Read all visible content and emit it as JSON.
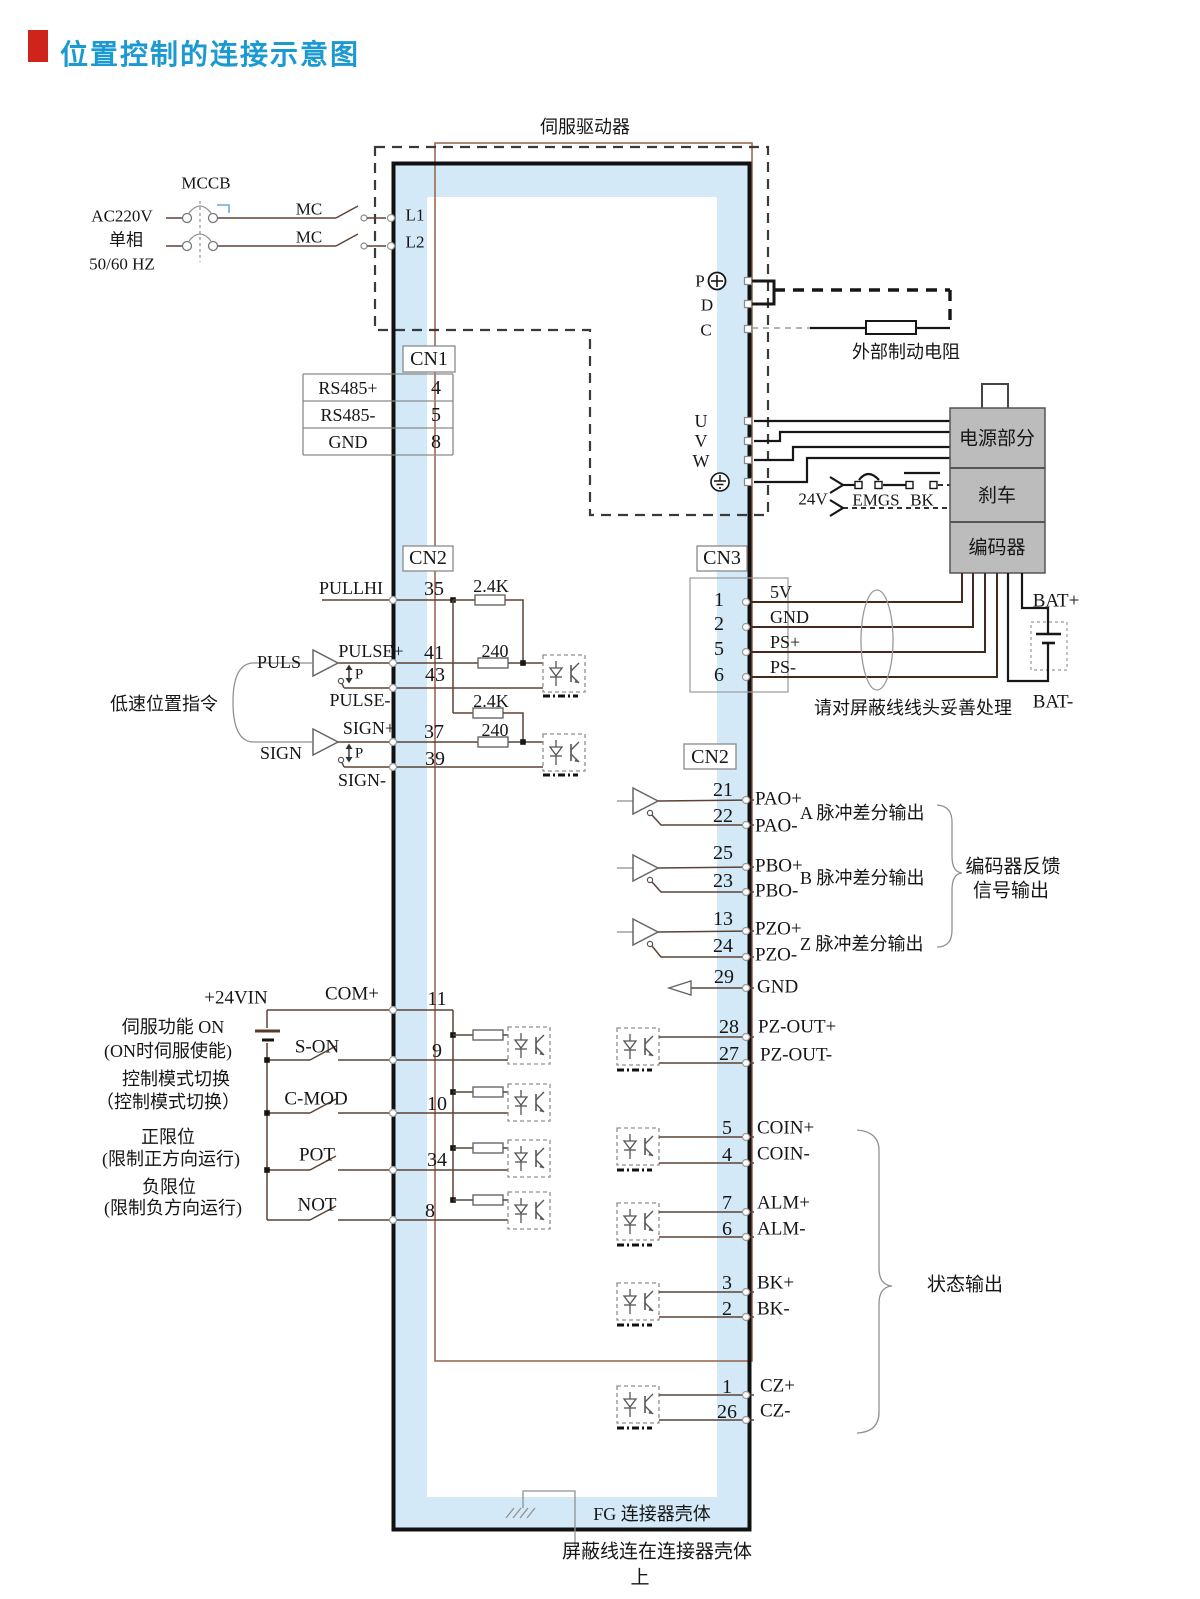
{
  "title": "位置控制的连接示意图",
  "drive_label": "伺服驱动器",
  "colors": {
    "accent_red": "#cf241c",
    "title_blue": "#1b9ad2",
    "band_blue": "#d3e9f7",
    "panel_gray": "#bcbcbc"
  },
  "power_input": {
    "voltage": "AC220V",
    "phase": "单相",
    "freq": "50/60 HZ",
    "breaker": "MCCB",
    "mc1": "MC",
    "mc2": "MC",
    "l1": "L1",
    "l2": "L2"
  },
  "dc_bus": {
    "p": "P",
    "d": "D",
    "c": "C",
    "ext_res": "外部制动电阻"
  },
  "motor": {
    "u": "U",
    "v": "V",
    "w": "W",
    "power": "电源部分",
    "brake": "刹车",
    "encoder": "编码器",
    "v24": "24V",
    "emgs": "EMGS",
    "bk": "BK"
  },
  "cn1": {
    "label": "CN1",
    "rows": [
      {
        "name": "RS485+",
        "pin": "4"
      },
      {
        "name": "RS485-",
        "pin": "5"
      },
      {
        "name": "GND",
        "pin": "8"
      }
    ]
  },
  "cn2_in": {
    "label": "CN2",
    "pullhi": "PULLHI",
    "pin_pullhi": "35",
    "r_pullup1": "2.4K",
    "pulse_plus": "PULSE+",
    "pin_pulse_plus": "41",
    "r_pulse": "240",
    "puls": "PULS",
    "p1": "P",
    "pin_pulse_minus": "43",
    "pulse_minus": "PULSE-",
    "r_pullup2": "2.4K",
    "sign_plus": "SIGN+",
    "pin_sign_plus": "37",
    "r_sign": "240",
    "sign": "SIGN",
    "p2": "P",
    "pin_sign_minus": "39",
    "sign_minus": "SIGN-",
    "group": "低速位置指令"
  },
  "cn3": {
    "label": "CN3",
    "rows": [
      {
        "pin": "1",
        "name": "5V"
      },
      {
        "pin": "2",
        "name": "GND"
      },
      {
        "pin": "5",
        "name": "PS+"
      },
      {
        "pin": "6",
        "name": "PS-"
      }
    ],
    "bat_plus": "BAT+",
    "bat_minus": "BAT-",
    "note": "请对屏蔽线线头妥善处理"
  },
  "cn2_out": {
    "label": "CN2",
    "rows": [
      {
        "pin_p": "21",
        "name_p": "PAO+",
        "pin_m": "22",
        "name_m": "PAO-",
        "desc": "A 脉冲差分输出"
      },
      {
        "pin_p": "25",
        "name_p": "PBO+",
        "pin_m": "23",
        "name_m": "PBO-",
        "desc": "B 脉冲差分输出"
      },
      {
        "pin_p": "13",
        "name_p": "PZO+",
        "pin_m": "24",
        "name_m": "PZO-",
        "desc": "Z 脉冲差分输出"
      }
    ],
    "pin_gnd": "29",
    "gnd": "GND",
    "fb1": "编码器反馈",
    "fb2": "信号输出"
  },
  "din": {
    "v24": "+24VIN",
    "com": "COM+",
    "pin_com": "11",
    "rows": [
      {
        "desc1": "伺服功能 ON",
        "desc2": "(ON时伺服使能)",
        "signal": "S-ON",
        "pin": "9"
      },
      {
        "desc1": "控制模式切换",
        "desc2": "（控制模式切换）",
        "signal": "C-MOD",
        "pin": "10"
      },
      {
        "desc1": "正限位",
        "desc2": "(限制正方向运行)",
        "signal": "POT",
        "pin": "34"
      },
      {
        "desc1": "负限位",
        "desc2": "(限制负方向运行)",
        "signal": "NOT",
        "pin": "8"
      }
    ]
  },
  "dout": {
    "pz": {
      "pin_p": "28",
      "name_p": "PZ-OUT+",
      "pin_m": "27",
      "name_m": "PZ-OUT-"
    },
    "rows": [
      {
        "pin_p": "5",
        "name_p": "COIN+",
        "pin_m": "4",
        "name_m": "COIN-"
      },
      {
        "pin_p": "7",
        "name_p": "ALM+",
        "pin_m": "6",
        "name_m": "ALM-"
      },
      {
        "pin_p": "3",
        "name_p": "BK+",
        "pin_m": "2",
        "name_m": "BK-"
      },
      {
        "pin_p": "1",
        "name_p": "CZ+",
        "pin_m": "26",
        "name_m": "CZ-"
      }
    ],
    "status": "状态输出"
  },
  "fg": {
    "label": "FG 连接器壳体",
    "note1": "屏蔽线连在连接器壳体",
    "note2": "上"
  }
}
